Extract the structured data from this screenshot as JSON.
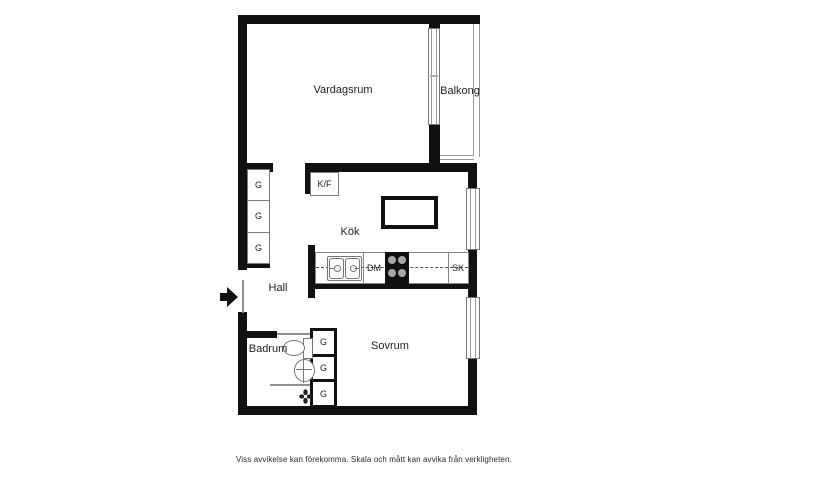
{
  "floorplan": {
    "rooms": {
      "vardagsrum": "Vardagsrum",
      "balkong": "Balkong",
      "kok": "Kök",
      "hall": "Hall",
      "badrum": "Badrum",
      "sovrum": "Sovrum"
    },
    "appliances": {
      "fridge_freezer": "K/F",
      "dishwasher": "DM",
      "cabinet": "SK"
    },
    "wardrobes_hall": [
      "G",
      "G",
      "G"
    ],
    "wardrobes_bedroom": [
      "G",
      "G",
      "G"
    ],
    "disclaimer": "Viss avvikelse kan förekomma. Skala och mått kan avvika från verkligheten.",
    "colors": {
      "wall": "#111111",
      "thin_line": "#8f8f8f",
      "burner": "#a8a8a8",
      "background": "#ffffff"
    }
  }
}
